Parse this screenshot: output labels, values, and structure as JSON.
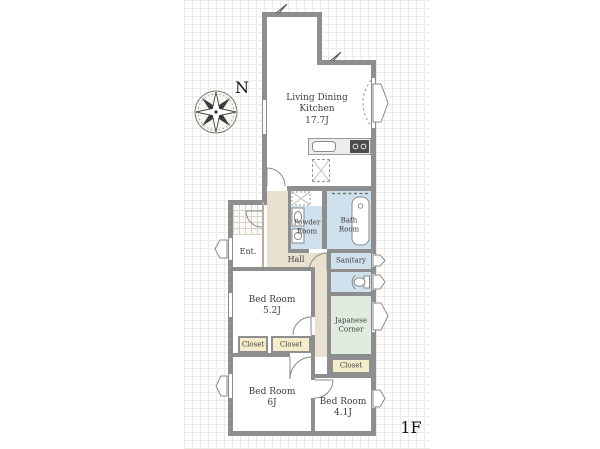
{
  "plan": {
    "compass_label": "N",
    "floor_label": "1F",
    "ldk": {
      "line1": "Living Dining",
      "line2": "Kitchen",
      "area": "17.7J"
    },
    "powder_room": {
      "line1": "Powder",
      "line2": "Room"
    },
    "bath_room": {
      "line1": "Bath",
      "line2": "Room"
    },
    "sanitary": {
      "name": "Sanitary"
    },
    "japanese_corner": {
      "line1": "Japanese",
      "line2": "Corner"
    },
    "closet_right": {
      "name": "Closet"
    },
    "entrance": {
      "name": "Ent."
    },
    "hall": {
      "name": "Hall"
    },
    "bedroom_52": {
      "name": "Bed Room",
      "area": "5.2J"
    },
    "closet_left": {
      "name": "Closet"
    },
    "closet_mid": {
      "name": "Closet"
    },
    "bedroom_6": {
      "name": "Bed Room",
      "area": "6J"
    },
    "bedroom_41": {
      "name": "Bed Room",
      "area": "4.1J"
    },
    "colors": {
      "wall": "#8e8e8e",
      "wet_room": "#cfe1ec",
      "tatami_room": "#e0ecdf",
      "closet": "#f4ecca",
      "hall_floor": "#e9e1d0"
    }
  }
}
